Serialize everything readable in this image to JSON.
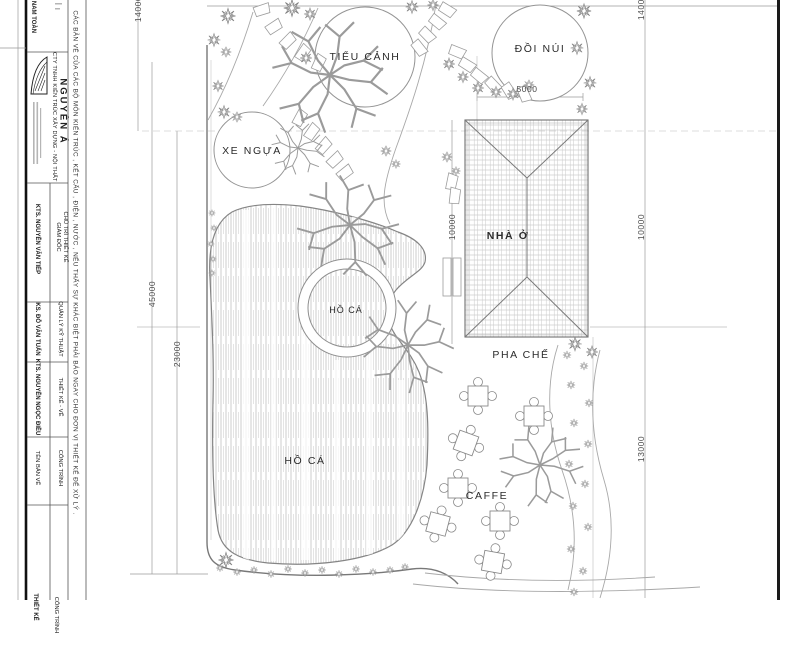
{
  "drawing": {
    "areas": [
      {
        "label": "TIỂU CẢNH"
      },
      {
        "label": "ĐỒI NÚI"
      },
      {
        "label": "XE NGỰA"
      },
      {
        "label": "NHÀ Ở"
      },
      {
        "label": "PHA CHẾ"
      },
      {
        "label": "HỒ CÁ"
      },
      {
        "label": "HỒ CÁ"
      },
      {
        "label": "CAFFE"
      }
    ],
    "dimensions": {
      "total_height": "45000",
      "segment_left": "23000",
      "top_left": "14000",
      "top_right": "14000",
      "house_left": "10000",
      "house_right": "10000",
      "cafe_right": "13000",
      "hill_width": "5000"
    }
  },
  "title_block": {
    "investor": "NAM TOÀN",
    "note": "CÁC BẢN VẼ CỦA CÁC BỘ MÔN KIẾN TRÚC , KẾT CẤU , ĐIỆN , NƯỚC , NẾU THẤY SỰ KHÁC BIỆT PHẢI BÁO NGAY CHO ĐƠN VỊ THIẾT KẾ ĐỂ XỬ LÝ .",
    "company": "CTY TNHH KIẾN TRÚC XÂY DỰNG - NỘI THẤT",
    "brand": "NGUYÊN Á",
    "logo": "nguyen-a-sail-logo",
    "staff": [
      {
        "role": "GIÁM ĐỐC",
        "role2": "CHỦ TRÌ THIẾT KẾ",
        "name": "KTS. NGUYỄN VĂN TIẾP"
      },
      {
        "role": "QUẢN LÝ KỸ THUẬT",
        "name": "KS. ĐỖ VĂN TUẤN"
      },
      {
        "role": "THIẾT KẾ - VẼ",
        "name": "KTS. NGUYỄN NGỌC ĐIỀU"
      }
    ],
    "fields": {
      "drawing_name_label": "TÊN BẢN VẼ",
      "project_label": "CÔNG TRÌNH",
      "drawing_name_value": "THIẾT KẾ",
      "project_value": "CÔNG TRÌNH"
    }
  }
}
